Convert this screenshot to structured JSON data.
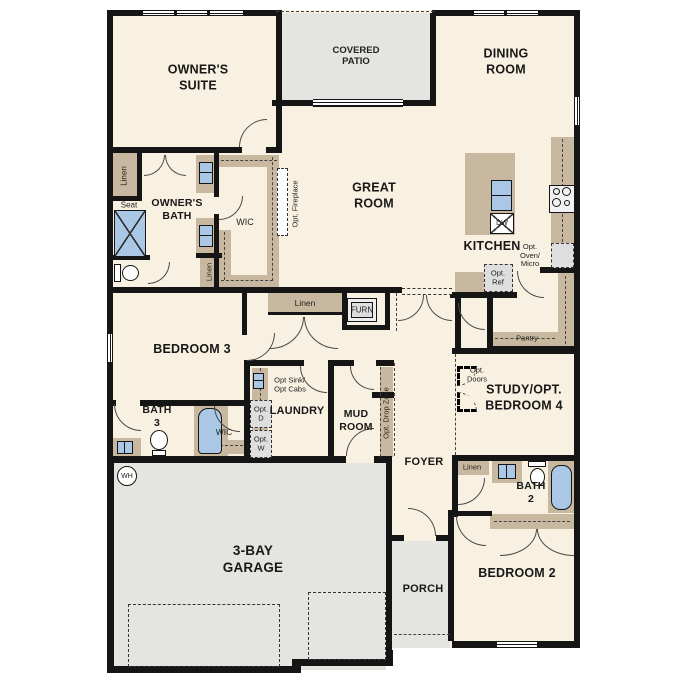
{
  "title": "Single-story home floor plan",
  "palette": {
    "floor": "#f8f1e2",
    "outdoor_gray": "#e4e4e1",
    "cabinet_tan": "#c9b8a0",
    "wall_black": "#151515",
    "fixture_blue": "#aac8e6",
    "optional_gray": "#dedede"
  },
  "labels": {
    "owners_suite": "OWNER'S\nSUITE",
    "covered_patio": "COVERED\nPATIO",
    "dining_room": "DINING\nROOM",
    "great_room": "GREAT\nROOM",
    "owners_bath": "OWNER'S\nBATH",
    "wic_owner": "WIC",
    "kitchen": "KITCHEN",
    "pantry": "Pantry",
    "bedroom3": "BEDROOM 3",
    "bath3": "BATH\n3",
    "wic_bed3": "WIC",
    "laundry": "LAUNDRY",
    "mud_room": "MUD\nROOM",
    "foyer": "FOYER",
    "study": "STUDY/OPT.\nBEDROOM 4",
    "bath2": "BATH\n2",
    "bedroom2": "BEDROOM 2",
    "garage": "3-BAY\nGARAGE",
    "porch": "PORCH",
    "linen_owner": "Linen",
    "linen_wic": "Linen",
    "linen_hall": "Linen",
    "linen_bath2": "Linen",
    "seat": "Seat",
    "furn": "FURN",
    "dw": "DW",
    "wh": "WH",
    "opt_fireplace": "Opt. Fireplace",
    "opt_oven_micro": "Opt.\nOven/\nMicro",
    "opt_ref": "Opt.\nRef",
    "opt_sink_cabs": "Opt Sink/\nOpt Cabs",
    "opt_d": "Opt.\nD",
    "opt_w": "Opt.\nW",
    "opt_doors": "Opt.\nDoors",
    "opt_drop_zone": "Opt. Drop Zone"
  },
  "fixtures": {
    "owners_shower": "walk-in-shower",
    "owners_vanity_sinks": "double-vanity-sinks",
    "owners_toilet": "toilet",
    "kitchen_island_sink": "double-basin-sink",
    "dishwasher": "dishwasher",
    "cooktop": "4-burner-cooktop",
    "optional_fridge": "refrigerator",
    "bath3_shower": "shower",
    "bath3_toilet": "toilet",
    "bath3_sink": "vanity-sink",
    "laundry_optional_sink": "utility-sink",
    "washer": "washer",
    "dryer": "dryer",
    "water_heater": "water-heater",
    "furnace": "furnace",
    "bath2_tub": "bathtub",
    "bath2_toilet": "toilet",
    "bath2_sink": "vanity-sink"
  }
}
